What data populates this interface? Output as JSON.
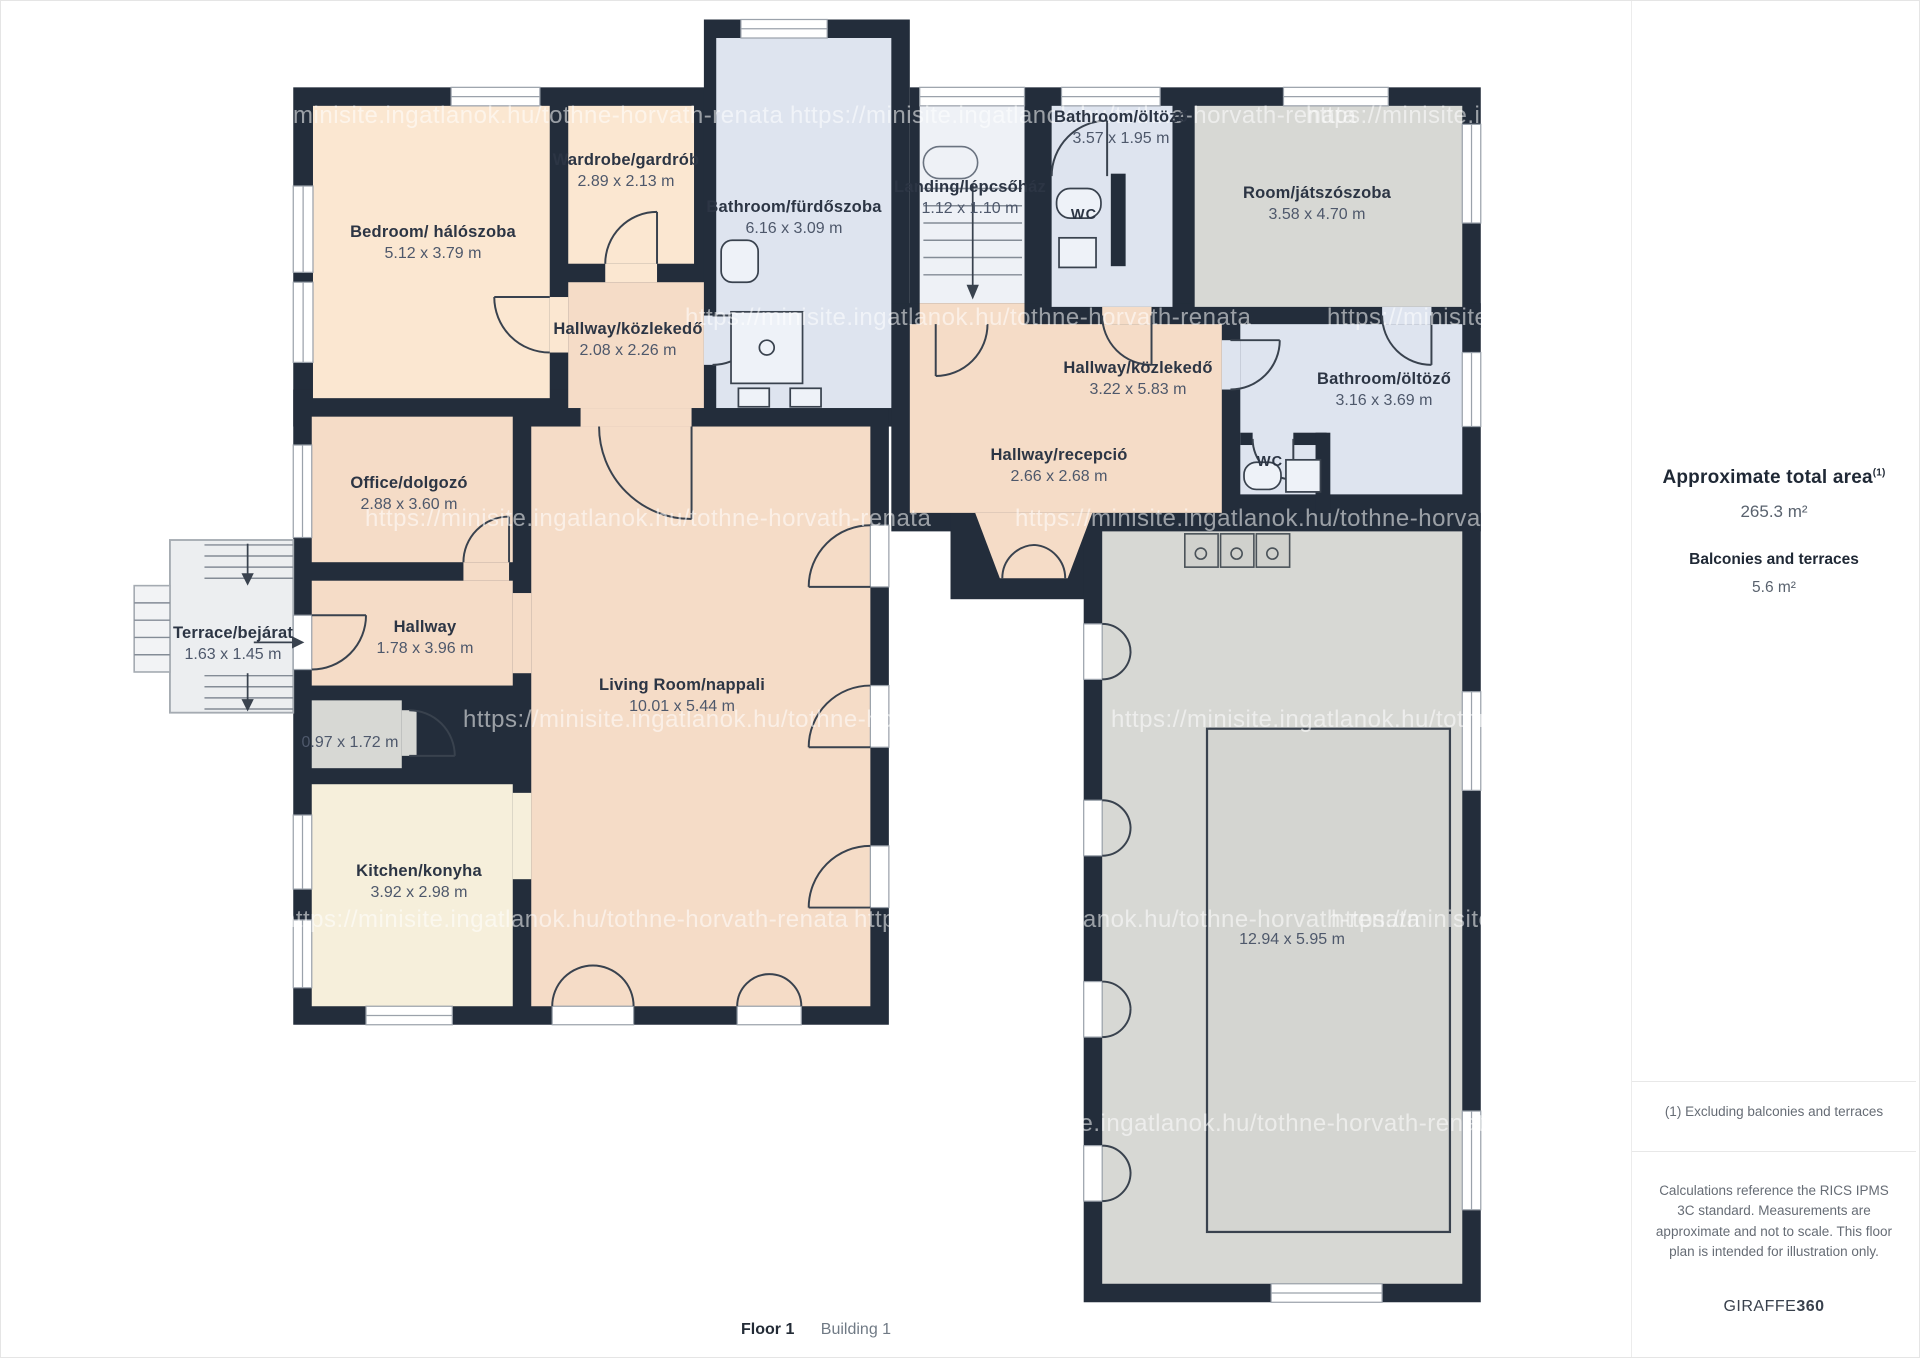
{
  "page": {
    "title_floor": "Floor 1",
    "title_building": "Building 1"
  },
  "colors": {
    "wall": "#232d3b",
    "peach1": "#fbe7d1",
    "peach": "#f5dcc7",
    "blue": "#dee4ef",
    "gray": "#d7d8d4",
    "cream": "#f6efdb",
    "terrace": "#eceef0",
    "landing": "#eef1f6",
    "label-dark": "#2c3544",
    "label-gray": "#4e586b",
    "sb-dark": "#1f2835",
    "sb-gray": "#59626e",
    "divider": "#e8e8e8",
    "fixture": "#eef2f8"
  },
  "sidebar": {
    "total_area_label": "Approximate total area",
    "total_area_sup": "(1)",
    "total_area_value": "265.3 m²",
    "balconies_label": "Balconies and terraces",
    "balconies_value": "5.6 m²",
    "footnote": "(1) Excluding balconies and terraces",
    "disclaimer": "Calculations reference the RICS IPMS 3C standard. Measurements are approximate and not to scale. This floor plan is intended for illustration only.",
    "brand_name": "GIRAFFE",
    "brand_suffix": "360"
  },
  "watermark": {
    "text": "https://minisite.ingatlanok.hu/tothne-horvath-renata",
    "positions": [
      {
        "x": 216,
        "y": 115
      },
      {
        "x": 789,
        "y": 115
      },
      {
        "x": 1305,
        "y": 115
      },
      {
        "x": 684,
        "y": 317
      },
      {
        "x": 1326,
        "y": 317
      },
      {
        "x": 364,
        "y": 518
      },
      {
        "x": 1014,
        "y": 518
      },
      {
        "x": 462,
        "y": 719
      },
      {
        "x": 1110,
        "y": 719
      },
      {
        "x": 281,
        "y": 919
      },
      {
        "x": 853,
        "y": 919
      },
      {
        "x": 1330,
        "y": 919
      },
      {
        "x": 931,
        "y": 1123
      }
    ]
  },
  "plan": {
    "rooms": [
      {
        "id": "bedroom",
        "name": "Bedroom/ hálószoba",
        "dims": "5.12 x 3.79 m",
        "x": 432,
        "y": 242
      },
      {
        "id": "wardrobe",
        "name": "Wardrobe/gardrób",
        "dims": "2.89 x 2.13 m",
        "x": 625,
        "y": 170
      },
      {
        "id": "bathroom-furdoszoba",
        "name": "Bathroom/fürdőszoba",
        "dims": "6.16 x 3.09 m",
        "x": 793,
        "y": 217
      },
      {
        "id": "landing-lepcsohaz",
        "name": "Landing/lépcsőház",
        "dims": "1.12 x 1.10 m",
        "x": 969,
        "y": 197
      },
      {
        "id": "bathroom-oltozo-top",
        "name": "Bathroom/öltöző",
        "dims": "3.57 x 1.95 m",
        "x": 1120,
        "y": 127
      },
      {
        "id": "room-jatszoszoba",
        "name": "Room/játszószoba",
        "dims": "3.58 x 4.70 m",
        "x": 1316,
        "y": 203
      },
      {
        "id": "hallway-kozlekedo-small",
        "name": "Hallway/közlekedő",
        "dims": "2.08 x 2.26 m",
        "x": 627,
        "y": 339
      },
      {
        "id": "hallway-kozlekedo-big",
        "name": "Hallway/közlekedő",
        "dims": "3.22 x 5.83 m",
        "x": 1137,
        "y": 378
      },
      {
        "id": "bathroom-oltozo-right",
        "name": "Bathroom/öltöző",
        "dims": "3.16 x 3.69 m",
        "x": 1383,
        "y": 389
      },
      {
        "id": "hallway-recepcio",
        "name": "Hallway/recepció",
        "dims": "2.66 x 2.68 m",
        "x": 1058,
        "y": 465
      },
      {
        "id": "office-dolgozo",
        "name": "Office/dolgozó",
        "dims": "2.88 x 3.60 m",
        "x": 408,
        "y": 493
      },
      {
        "id": "terrace-bejarat",
        "name": "Terrace/bejárat",
        "dims": "1.63 x 1.45 m",
        "x": 232,
        "y": 643
      },
      {
        "id": "hallway",
        "name": "Hallway",
        "dims": "1.78 x 3.96 m",
        "x": 424,
        "y": 637
      },
      {
        "id": "room-small",
        "name": "",
        "dims": "0.97 x 1.72 m",
        "x": 349,
        "y": 742
      },
      {
        "id": "living-room",
        "name": "Living Room/nappali",
        "dims": "10.01 x 5.44 m",
        "x": 681,
        "y": 695
      },
      {
        "id": "kitchen-konyha",
        "name": "Kitchen/konyha",
        "dims": "3.92 x 2.98 m",
        "x": 418,
        "y": 881
      },
      {
        "id": "garage",
        "name": "",
        "dims": "12.94 x 5.95 m",
        "x": 1291,
        "y": 939
      },
      {
        "id": "room-wc-top",
        "name": "WC",
        "dims": "",
        "x": 1083,
        "y": 214
      },
      {
        "id": "room-wc-right",
        "name": "WC",
        "dims": "",
        "x": 1269,
        "y": 461
      }
    ]
  }
}
